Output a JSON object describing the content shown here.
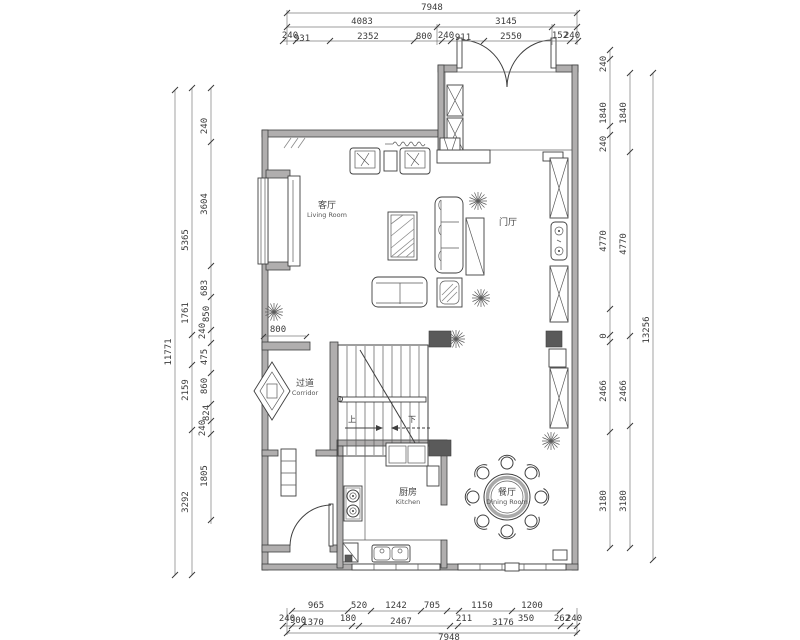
{
  "drawing": {
    "rooms": {
      "living_zh": "客厅",
      "living_en": "Living Room",
      "foyer_zh": "门厅",
      "corridor_zh": "过道",
      "corridor_en": "Corridor",
      "kitchen_zh": "厨房",
      "kitchen_en": "Kitchen",
      "dining_zh": "餐厅",
      "dining_en": "Dining Room"
    },
    "stairs": {
      "up": "上",
      "down": "下"
    },
    "annotations": {
      "niche_width": "800"
    }
  },
  "dims": {
    "top": {
      "total": "7948",
      "row2": [
        "4083",
        "3145"
      ],
      "row3": [
        "240",
        "931",
        "2352",
        "800",
        "240",
        "911",
        "2550",
        "152",
        "240"
      ]
    },
    "bottom": {
      "row1": [
        "965",
        "520",
        "1242",
        "705",
        "1150",
        "1200"
      ],
      "row2": [
        "240",
        "900",
        "1370",
        "180",
        "2467",
        "211",
        "3176",
        "350",
        "262",
        "240"
      ],
      "total": "7948"
    },
    "left": {
      "total": "11771",
      "mid": [
        "5365",
        "1761",
        "2159",
        "3292"
      ],
      "inner": [
        "240",
        "3604",
        "683",
        "850",
        "240",
        "475",
        "860",
        "824",
        "240",
        "1805"
      ]
    },
    "right": {
      "total": "13256",
      "mid": [
        "1840",
        "4770",
        "2466",
        "3180"
      ],
      "inner": [
        "240",
        "1840",
        "240",
        "4770",
        "0",
        "2466",
        "3180"
      ]
    }
  },
  "colors": {
    "line": "#3f3f3f",
    "wall_fill": "#b0aeae",
    "dim_text": "#3a3a3a"
  }
}
